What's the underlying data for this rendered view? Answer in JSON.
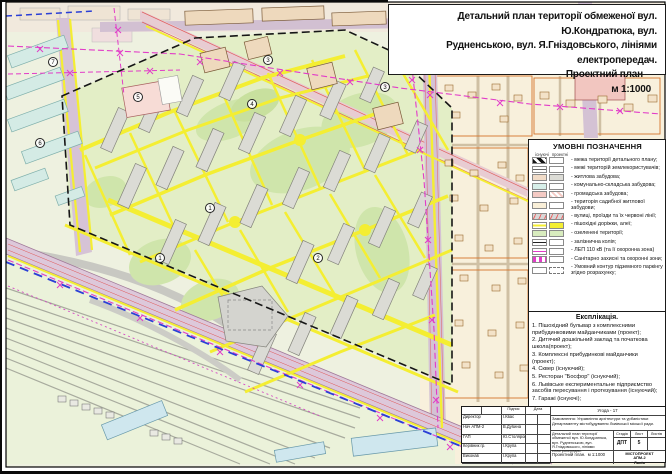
{
  "title": {
    "line1": "Детальний план території обмеженої вул. Ю.Кондратюка, вул.",
    "line2": "Рудненською, вул. Я.Гніздовського, лініями електропередач.",
    "line3": "Проектний план",
    "line4": "м 1:1000"
  },
  "legend": {
    "title": "УМОВНІ ПОЗНАЧЕННЯ",
    "col_existing": "існуючі",
    "col_project": "проектні",
    "items": [
      "- межа території детального плану;",
      "- межі територій землекористувачів;",
      "- житлова забудова;",
      "- комунально-складська забудова;",
      "- громадська забудова;",
      "- територія садибної житлової забудови;",
      "- вулиці, проїзди та їх червоні лінії;",
      "- пішохідні доріжки, алеї;",
      "- озеленені території;",
      "- залізнична колія;",
      "- ЛЕП 110 кВ (та її охоронна зона)",
      "- Санітарно захисні та охоронні зони;",
      "- Умовний контур підземного паркінгу згідно розрахунку;"
    ]
  },
  "explication": {
    "title": "Експлікація.",
    "items": [
      "1. Пішохідний бульвар з комплексними прибудинковими майданчиками (проект);",
      "2. Дитячий дошкільний заклад та початкова школа(проект);",
      "3. Комплексні прибудинкові майданчики (проект);",
      "4. Сквер (існуючий);",
      "5. Ресторан \"Босфор\" (існуючий);",
      "6. Львівське експериментальне підприємство засобів пересування і протезування (існуючий);",
      "7. Гаражі (існуючі);"
    ]
  },
  "stamp": {
    "agreement": "Угода  - 17",
    "sign_label": "Підпис",
    "date_label": "Дата",
    "rows": [
      {
        "r": "Директор",
        "n": "І.Квас"
      },
      {
        "r": "Нач АПМ-2",
        "n": "В.Дубина"
      },
      {
        "r": "ГАП",
        "n": "Ю.Столяров"
      },
      {
        "r": "Керівник гр.",
        "n": "І.Крупа"
      },
      {
        "r": "Виконав",
        "n": "І.Крупа"
      }
    ],
    "order": "Замовлення: Управління архітектури та урбаністики Департаменту містобудування Львівської міської ради.",
    "project": "Детальний план території обмеженої вул. Ю.Кондратюка, вул. Рудненською, вул. Я.Гніздовського, лініями електропередач.",
    "stage_label": "Стадія",
    "sheet_label": "Лист",
    "sheets_label": "Листів",
    "stage": "ДПТ",
    "sheet": "5",
    "sheets": "",
    "plan": "Проектний план.",
    "scale": "м 1:1000",
    "org1": "МІСТОПРОЕКТ",
    "org2": "АПМ-2",
    "org3": "Львів"
  },
  "map": {
    "markers": [
      {
        "n": "7"
      },
      {
        "n": "5"
      },
      {
        "n": "3"
      },
      {
        "n": "4"
      },
      {
        "n": "3"
      },
      {
        "n": "6"
      },
      {
        "n": "1"
      },
      {
        "n": "2"
      },
      {
        "n": "1"
      }
    ]
  },
  "colors": {
    "yellow_paths": "#f4ee32",
    "green_area": "#e3eec6",
    "residential_project": "#dbdbd5",
    "communal": "#d7efe9",
    "public": "#f4cac4",
    "manor": "#f8f0dc",
    "road": "#ddc8da",
    "lep_magenta": "#e23cc8",
    "boundary_black": "#161616",
    "blue_dash": "#2b3fd6",
    "red_line": "#e05555"
  }
}
